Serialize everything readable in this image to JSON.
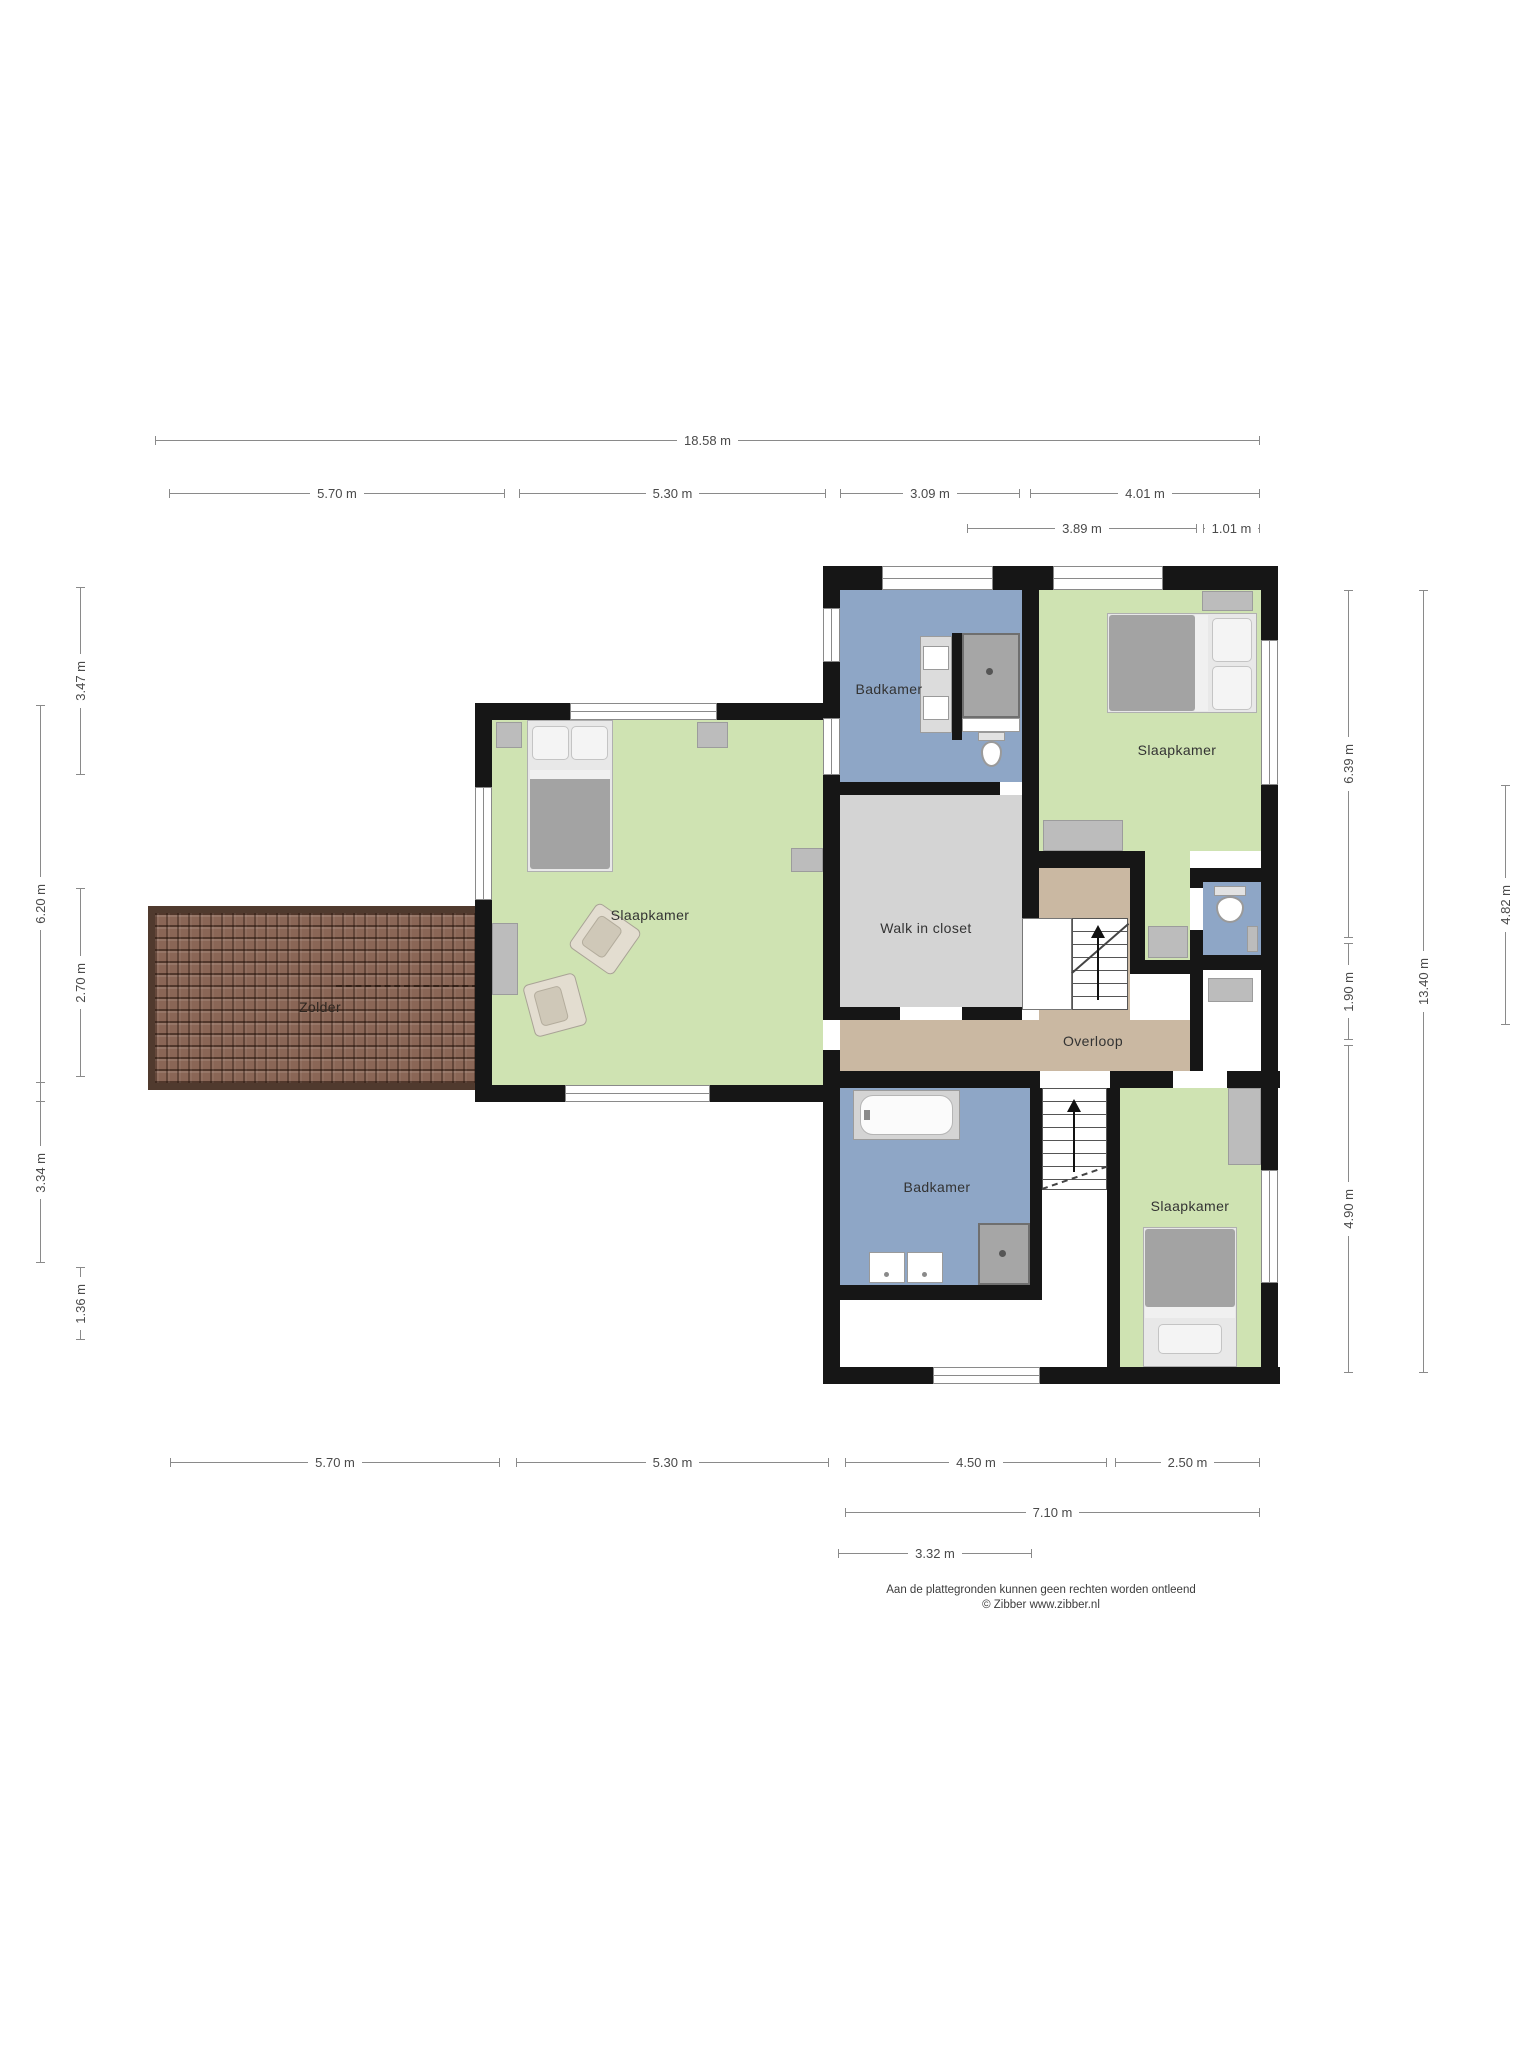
{
  "rooms": {
    "zolder": "Zolder",
    "slaapkamer_left": "Slaapkamer",
    "slaapkamer_top_right": "Slaapkamer",
    "slaapkamer_bottom_right": "Slaapkamer",
    "badkamer_top": "Badkamer",
    "badkamer_bottom": "Badkamer",
    "walk_in_closet": "Walk in closet",
    "overloop": "Overloop"
  },
  "dimensions": {
    "top": {
      "total": "18.58 m",
      "a": "5.70 m",
      "b": "5.30 m",
      "c": "3.09 m",
      "d": "4.01 m",
      "e": "3.89 m",
      "f": "1.01 m"
    },
    "bottom": {
      "a": "5.70 m",
      "b": "5.30 m",
      "c": "4.50 m",
      "d": "2.50 m",
      "e": "7.10 m",
      "f": "3.32 m"
    },
    "left": {
      "a": "3.47 m",
      "b": "6.20 m",
      "c": "2.70 m",
      "d": "3.34 m",
      "e": "1.36 m"
    },
    "right": {
      "a": "6.39 m",
      "b": "1.90 m",
      "c": "4.90 m",
      "d": "13.40 m",
      "e": "4.82 m"
    }
  },
  "footer": {
    "line1": "Aan de plattegronden kunnen geen rechten worden ontleend",
    "line2": "© Zibber www.zibber.nl"
  },
  "colors": {
    "wall": "#161616",
    "bedroom_green": "#cfe3b2",
    "bathroom_blue": "#8ea6c6",
    "closet_gray": "#d4d4d4",
    "hall_tan": "#cab8a2",
    "roof_brown": "#8a6656",
    "dimension_line": "#8a8a8a"
  }
}
